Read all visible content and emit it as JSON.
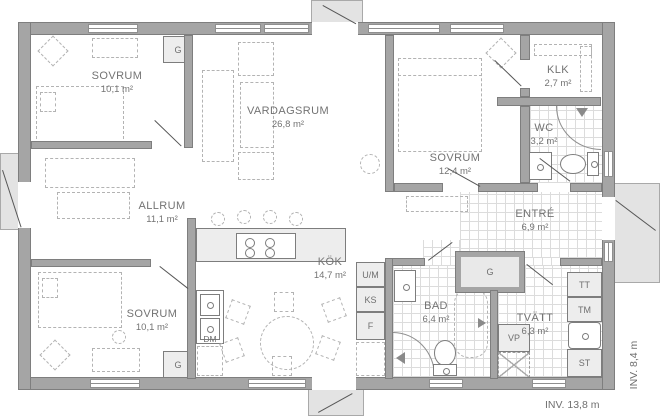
{
  "rooms": {
    "sovrum_tl": {
      "name": "SOVRUM",
      "area": "10,1 m²"
    },
    "vardagsrum": {
      "name": "VARDAGSRUM",
      "area": "26,8 m²"
    },
    "klk": {
      "name": "KLK",
      "area": "2,7 m²"
    },
    "wc": {
      "name": "WC",
      "area": "3,2 m²"
    },
    "sovrum_tr": {
      "name": "SOVRUM",
      "area": "12,4 m²"
    },
    "entre": {
      "name": "ENTRÉ",
      "area": "6,9 m²"
    },
    "allrum": {
      "name": "ALLRUM",
      "area": "11,1 m²"
    },
    "kok": {
      "name": "KÖK",
      "area": "14,7 m²"
    },
    "sovrum_bl": {
      "name": "SOVRUM",
      "area": "10,1 m²"
    },
    "bad": {
      "name": "BAD",
      "area": "6,4 m²"
    },
    "tvatt": {
      "name": "TVÄTT",
      "area": "6,3 m²"
    }
  },
  "labels": {
    "garderob": "G",
    "oven_micro": "U/M",
    "fridge": "KS",
    "freezer": "F",
    "dishwasher": "DM",
    "heat_pump": "VP",
    "dryer": "TT",
    "washer": "TM",
    "cleaning": "ST"
  },
  "dimensions": {
    "inner_width": "INV. 13,8 m",
    "inner_depth": "INV. 8,4 m"
  },
  "colors": {
    "wall": "#a5a5a5",
    "porch": "#e3e3e3",
    "text": "#737373"
  }
}
